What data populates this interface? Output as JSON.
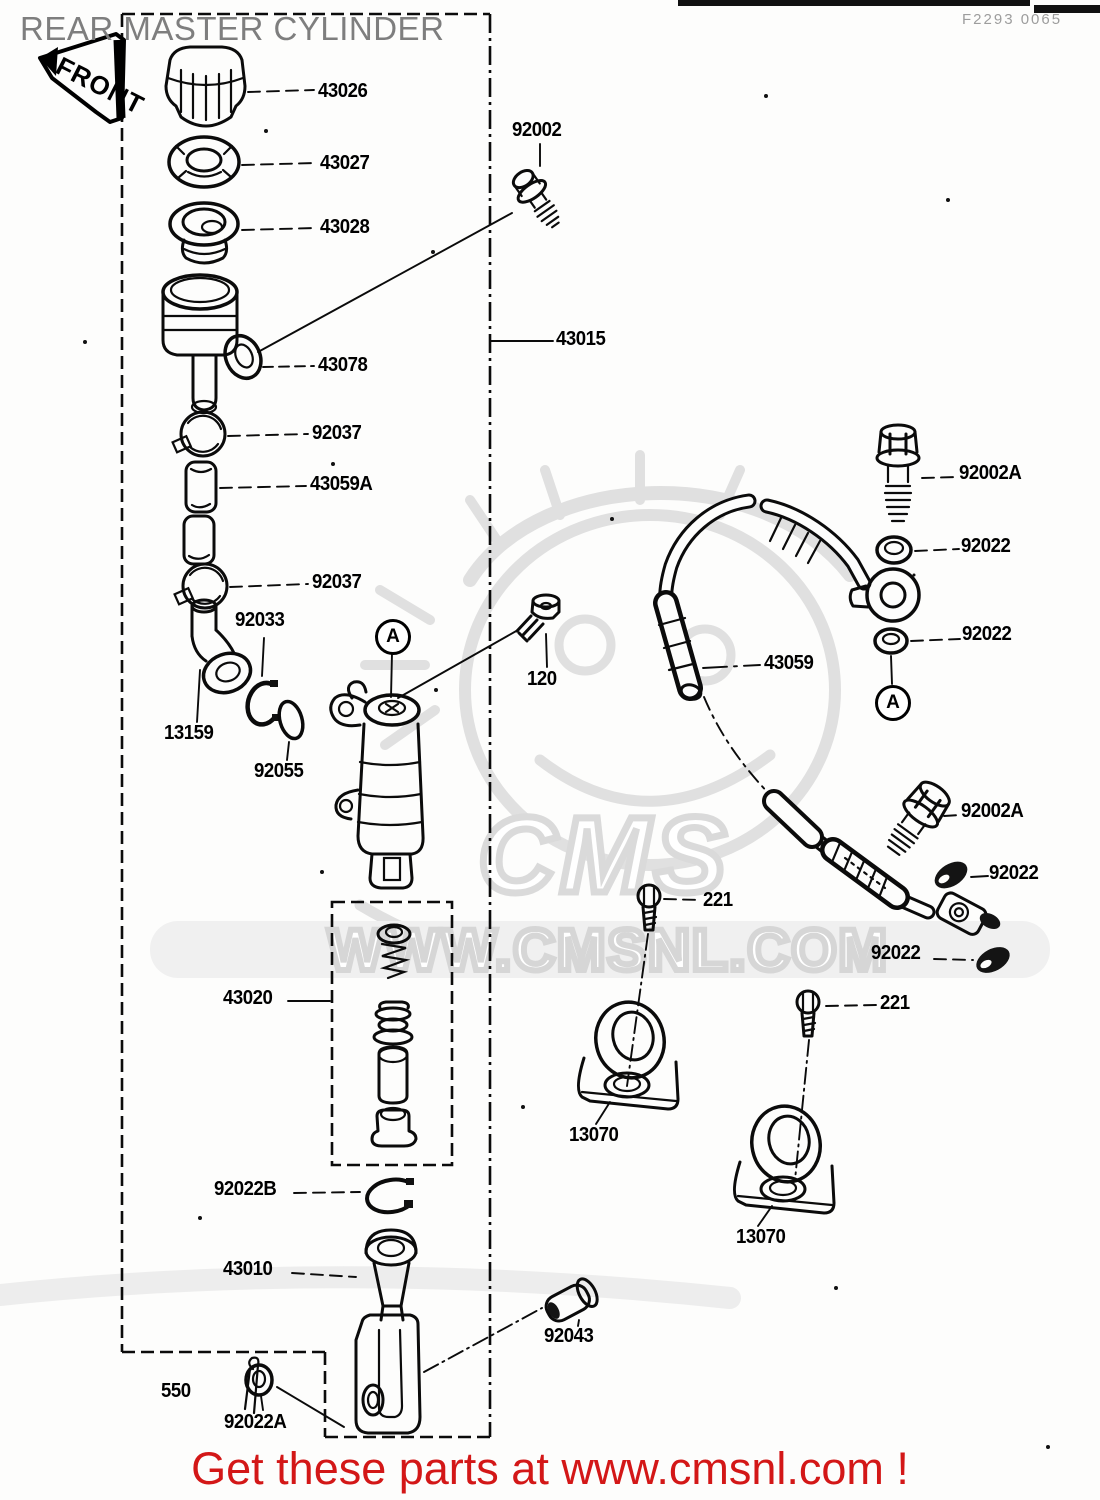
{
  "page": {
    "title": "REAR MASTER CYLINDER",
    "doc_code": "F2293 0065",
    "front_sign": "FRONT",
    "footer_text": "Get these parts at www.cmsnl.com !",
    "colors": {
      "footer_red": "#d31717",
      "title_gray": "#7e7e7e",
      "watermark_gray": "#dadada",
      "line_black": "#0b0b0b"
    }
  },
  "watermark": {
    "logo_text": "CMS",
    "site_text": "WWW.CMSNL.COM"
  },
  "diagram": {
    "circled_markers": [
      {
        "letter": "A"
      },
      {
        "letter": "A"
      }
    ],
    "labels": [
      {
        "text": "43026"
      },
      {
        "text": "43027"
      },
      {
        "text": "43028"
      },
      {
        "text": "92002"
      },
      {
        "text": "43078"
      },
      {
        "text": "43015"
      },
      {
        "text": "92037"
      },
      {
        "text": "43059A"
      },
      {
        "text": "92037"
      },
      {
        "text": "92033"
      },
      {
        "text": "13159"
      },
      {
        "text": "92055"
      },
      {
        "text": "120"
      },
      {
        "text": "92002A"
      },
      {
        "text": "92022"
      },
      {
        "text": "43059"
      },
      {
        "text": "92022"
      },
      {
        "text": "92002A"
      },
      {
        "text": "92022"
      },
      {
        "text": "221"
      },
      {
        "text": "92022"
      },
      {
        "text": "221"
      },
      {
        "text": "43020"
      },
      {
        "text": "13070"
      },
      {
        "text": "13070"
      },
      {
        "text": "92022B"
      },
      {
        "text": "43010"
      },
      {
        "text": "92043"
      },
      {
        "text": "550"
      },
      {
        "text": "92022A"
      }
    ]
  }
}
